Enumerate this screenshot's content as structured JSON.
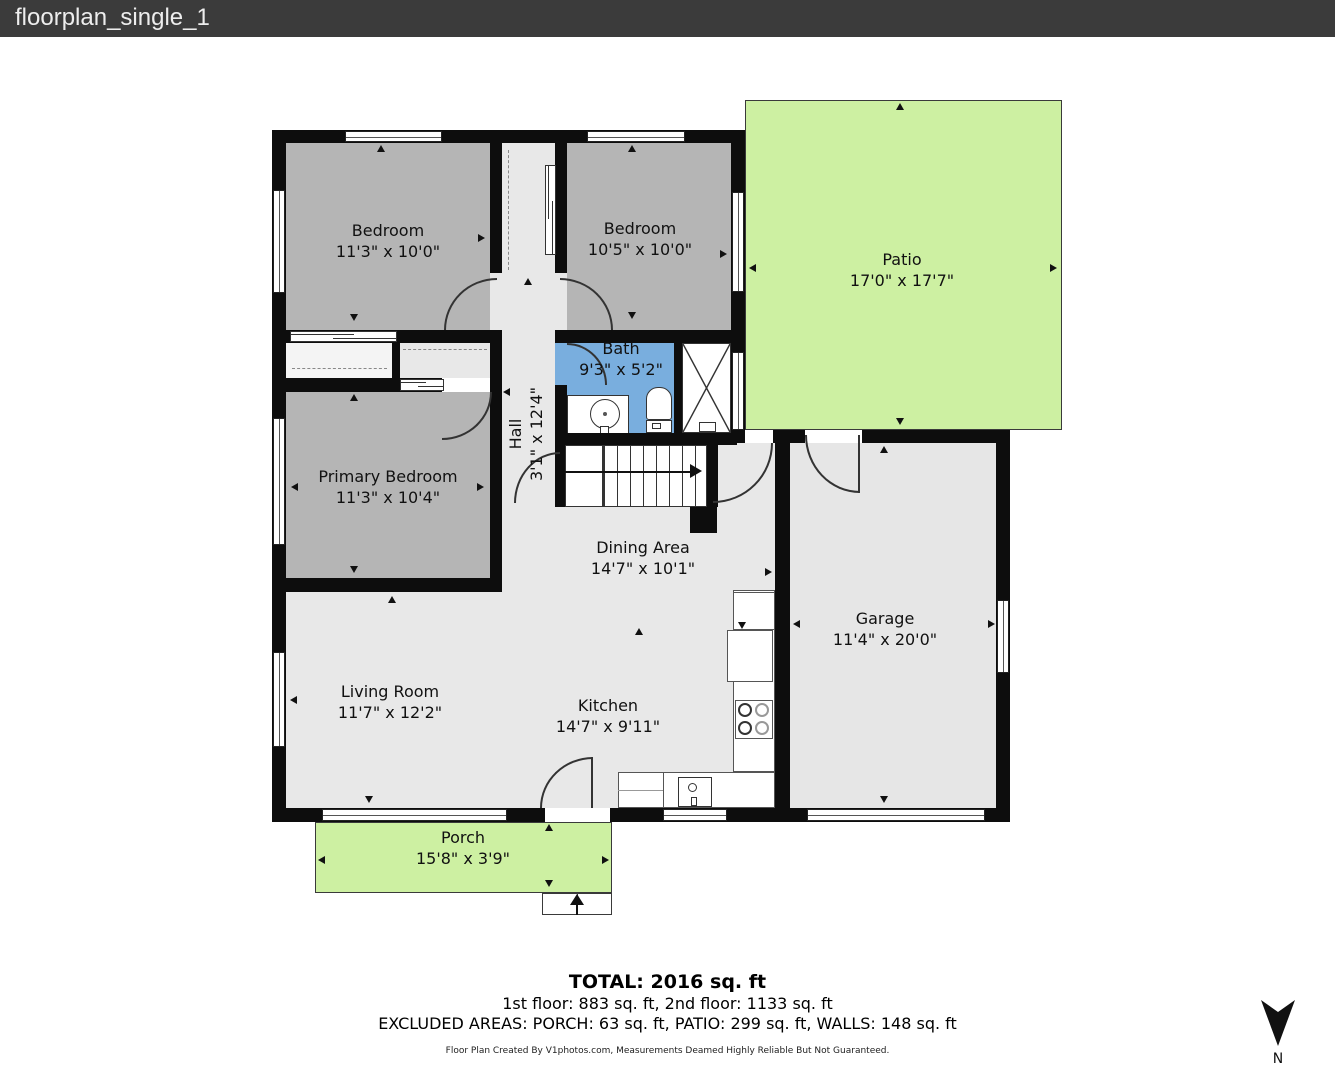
{
  "titlebar": {
    "title": "floorplan_single_1"
  },
  "colors": {
    "titlebar_bg": "#3b3b3b",
    "titlebar_text": "#ededed",
    "wall": "#0d0d0d",
    "bedroom_fill": "#b5b5b5",
    "floor_fill": "#e8e8e8",
    "bath_fill": "#79aede",
    "outdoor_fill": "#cdf0a2"
  },
  "rooms": [
    {
      "id": "bedroom-1",
      "name": "Bedroom",
      "dims": "11'3\" x 10'0\""
    },
    {
      "id": "bedroom-2",
      "name": "Bedroom",
      "dims": "10'5\" x 10'0\""
    },
    {
      "id": "patio",
      "name": "Patio",
      "dims": "17'0\" x 17'7\""
    },
    {
      "id": "bath",
      "name": "Bath",
      "dims": "9'3\" x 5'2\""
    },
    {
      "id": "hall",
      "name": "Hall",
      "dims": "3'1\" x 12'4\""
    },
    {
      "id": "primary-bedroom",
      "name": "Primary Bedroom",
      "dims": "11'3\" x 10'4\""
    },
    {
      "id": "dining-area",
      "name": "Dining Area",
      "dims": "14'7\" x 10'1\""
    },
    {
      "id": "garage",
      "name": "Garage",
      "dims": "11'4\" x 20'0\""
    },
    {
      "id": "living-room",
      "name": "Living Room",
      "dims": "11'7\" x 12'2\""
    },
    {
      "id": "kitchen",
      "name": "Kitchen",
      "dims": "14'7\" x 9'11\""
    },
    {
      "id": "porch",
      "name": "Porch",
      "dims": "15'8\" x 3'9\""
    }
  ],
  "summary": {
    "total": "TOTAL: 2016 sq. ft",
    "floors": "1st floor: 883 sq. ft, 2nd floor: 1133 sq. ft",
    "excluded": "EXCLUDED AREAS: PORCH: 63 sq. ft, PATIO: 299 sq. ft, WALLS: 148 sq. ft"
  },
  "credit": "Floor Plan Created By V1photos.com, Measurements Deamed Highly Reliable But Not Guaranteed.",
  "compass": {
    "label": "N"
  }
}
